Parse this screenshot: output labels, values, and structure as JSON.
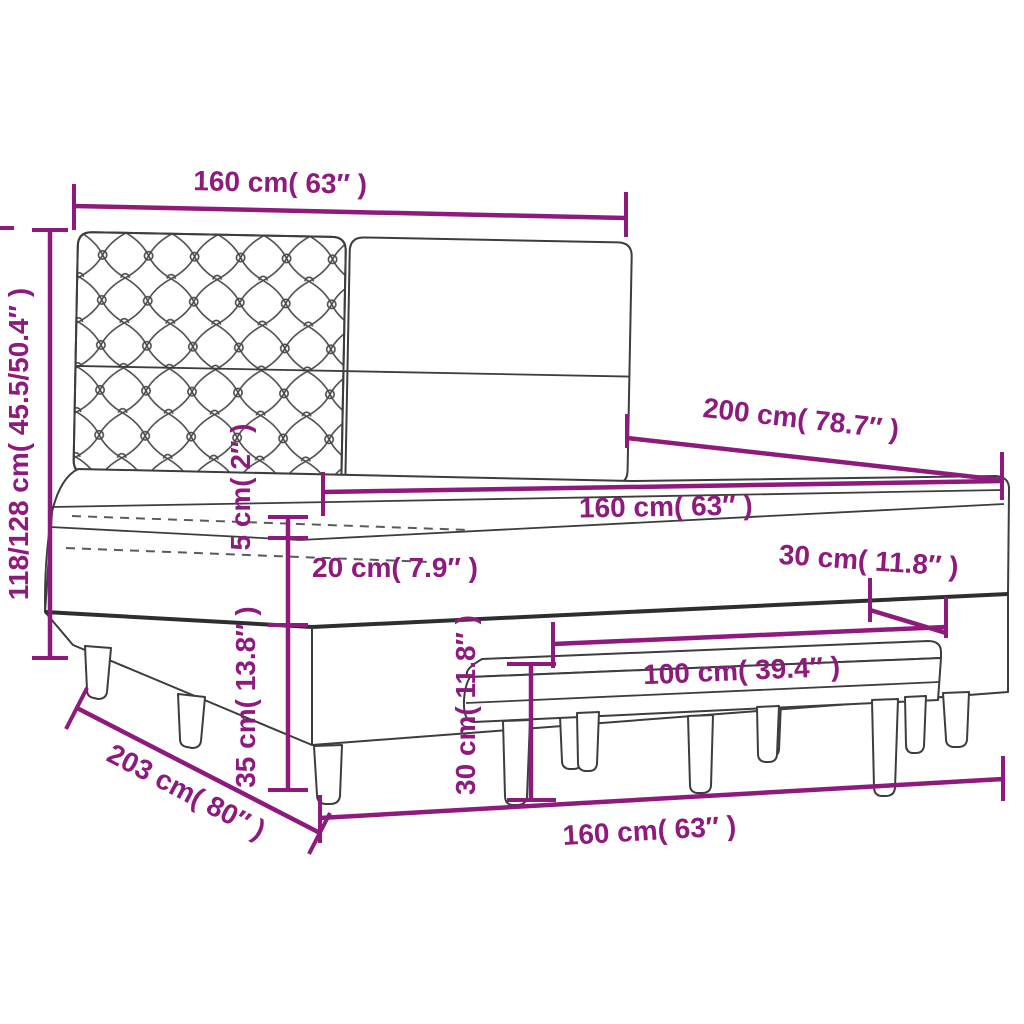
{
  "meta": {
    "background": "#ffffff",
    "accent_color": "#8E1A7E",
    "outline_color": "#3D3D3D"
  },
  "diagram": {
    "product": "Box spring bed with tufted headboard, mattress topper and bench",
    "dims": {
      "headboard_width": "160 cm( 63″ )",
      "total_height": "118/128 cm( 45.5/50.4″ )",
      "bed_length": "200 cm( 78.7″ )",
      "mattress_width": "160 cm( 63″ )",
      "topper_height": "5 cm( 2″ )",
      "mattress_height": "20 cm( 7.9″ )",
      "bench_depth": "30 cm( 11.8″ )",
      "base_height": "35 cm( 13.8″ )",
      "bench_height": "30 cm( 11.8″ )",
      "bench_width": "100 cm( 39.4″ )",
      "bed_total_length": "203 cm( 80″ )",
      "bed_width_bottom": "160 cm( 63″ )"
    }
  }
}
